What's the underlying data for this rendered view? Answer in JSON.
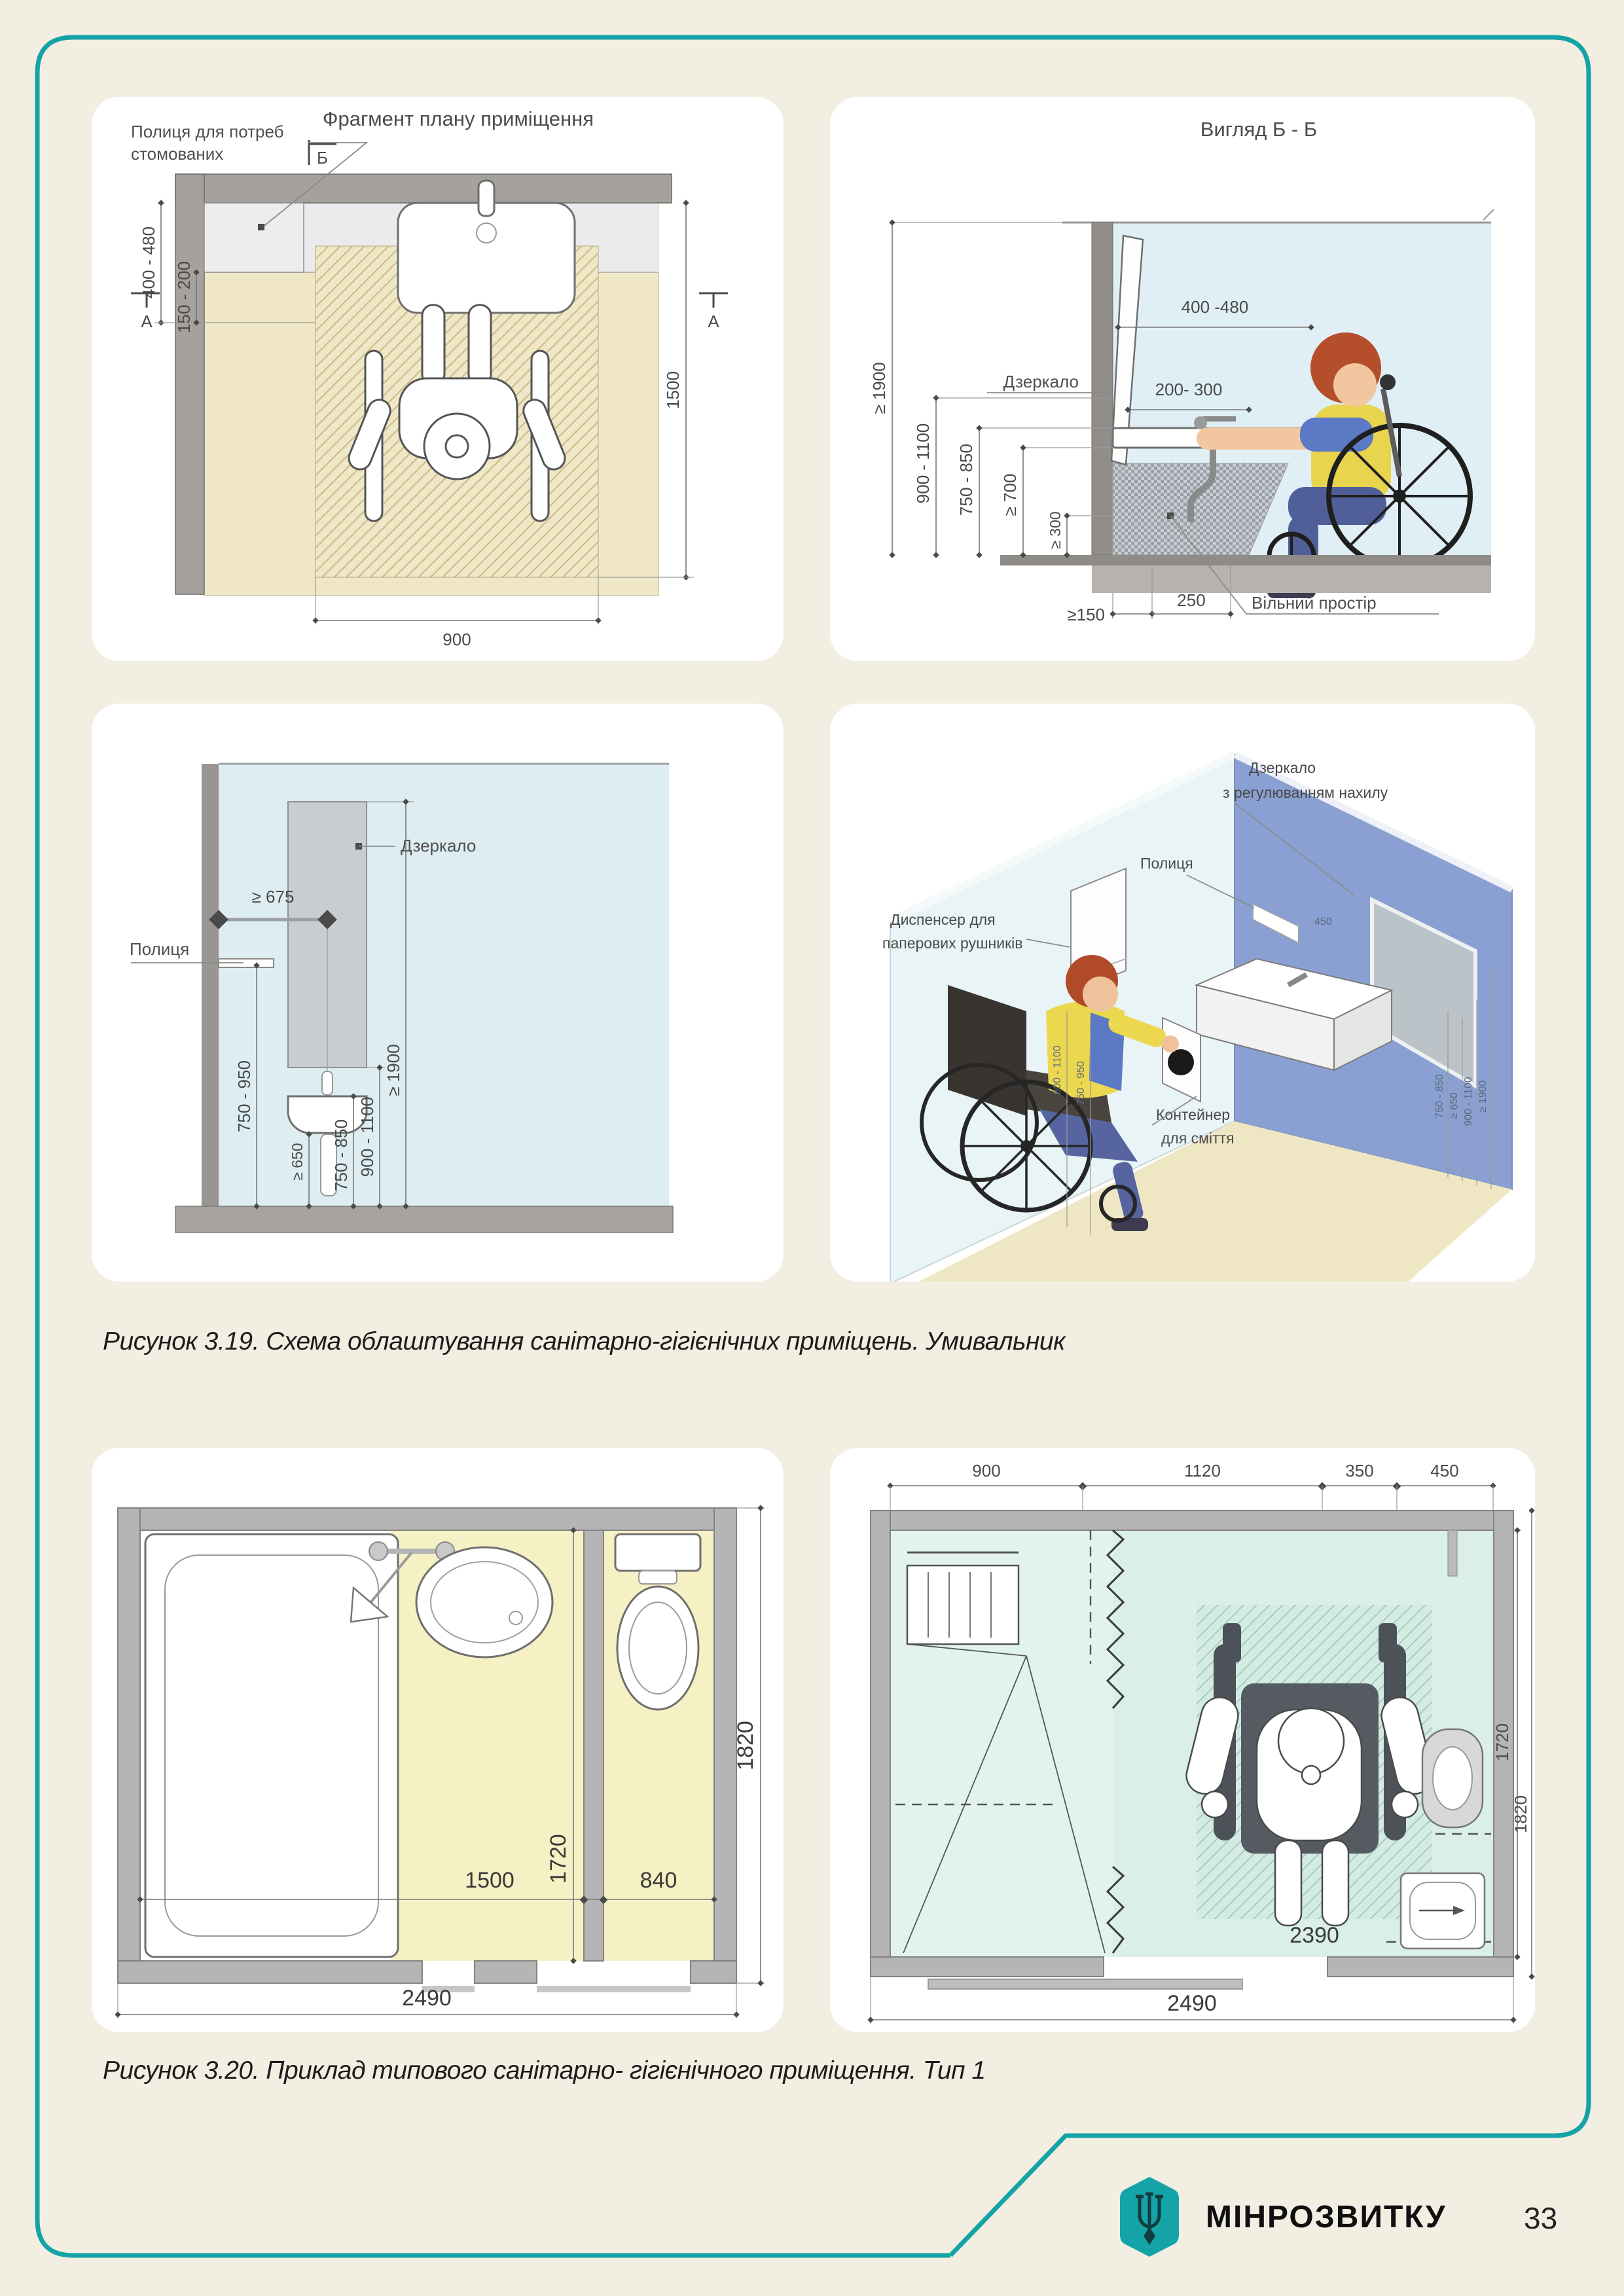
{
  "page": {
    "brand": "МІНРОЗВИТКУ",
    "number": "33",
    "accent": "#14a3a6"
  },
  "fig319": {
    "caption": "Рисунок 3.19. Схема облаштування санітарно-гігієнічних приміщень. Умивальник",
    "plan": {
      "title": "Фрагмент плану приміщення",
      "marker_b": "Б",
      "marker_a_left": "А",
      "marker_a_right": "А",
      "shelf1": "Полиця для потреб",
      "shelf2": "стомованих",
      "dim1": "400 - 480",
      "dim2": "150 - 200",
      "dim_depth": "1500",
      "dim_width": "900"
    },
    "view": {
      "title": "Вигляд Б - Б",
      "mirror": "Дзеркало",
      "free": "Вільний простір",
      "dim_mirror": "400 -480",
      "dim_reach": "200- 300",
      "h_total": "≥ 1900",
      "h1": "900 - 1100",
      "h2": "750 - 850",
      "h3": "≥ 700",
      "h4": "≥ 300",
      "b1": "≥150",
      "b2": "250"
    },
    "elev": {
      "mirror": "Дзеркало",
      "shelf": "Полиця",
      "w": "≥ 675",
      "h1": "750 - 950",
      "h2": "≥ 650",
      "h3": "750 - 850",
      "h4": "900 - 1100",
      "h5": "≥ 1900"
    },
    "iso": {
      "mirror1": "Дзеркало",
      "mirror2": "з регулюванням нахилу",
      "shelf": "Полиця",
      "disp1": "Диспенсер для",
      "disp2": "паперових рушників",
      "bin1": "Контейнер",
      "bin2": "для сміття",
      "d_shelf": "450",
      "d1": "800 - 1100",
      "d2": "750 - 950",
      "d3": "750 - 850",
      "d4": "≥ 650",
      "d5": "900 - 1100",
      "d6": "≥ 1900"
    }
  },
  "fig320": {
    "caption": "Рисунок 3.20. Приклад типового санітарно- гігієнічного приміщення. Тип 1",
    "left": {
      "w1": "1500",
      "depth": "1720",
      "w2": "840",
      "h": "1820",
      "total": "2490"
    },
    "right": {
      "t1": "900",
      "t2": "1120",
      "t3": "350",
      "t4": "450",
      "inner": "2390",
      "r1": "1720",
      "r2": "1820",
      "total": "2490"
    }
  }
}
